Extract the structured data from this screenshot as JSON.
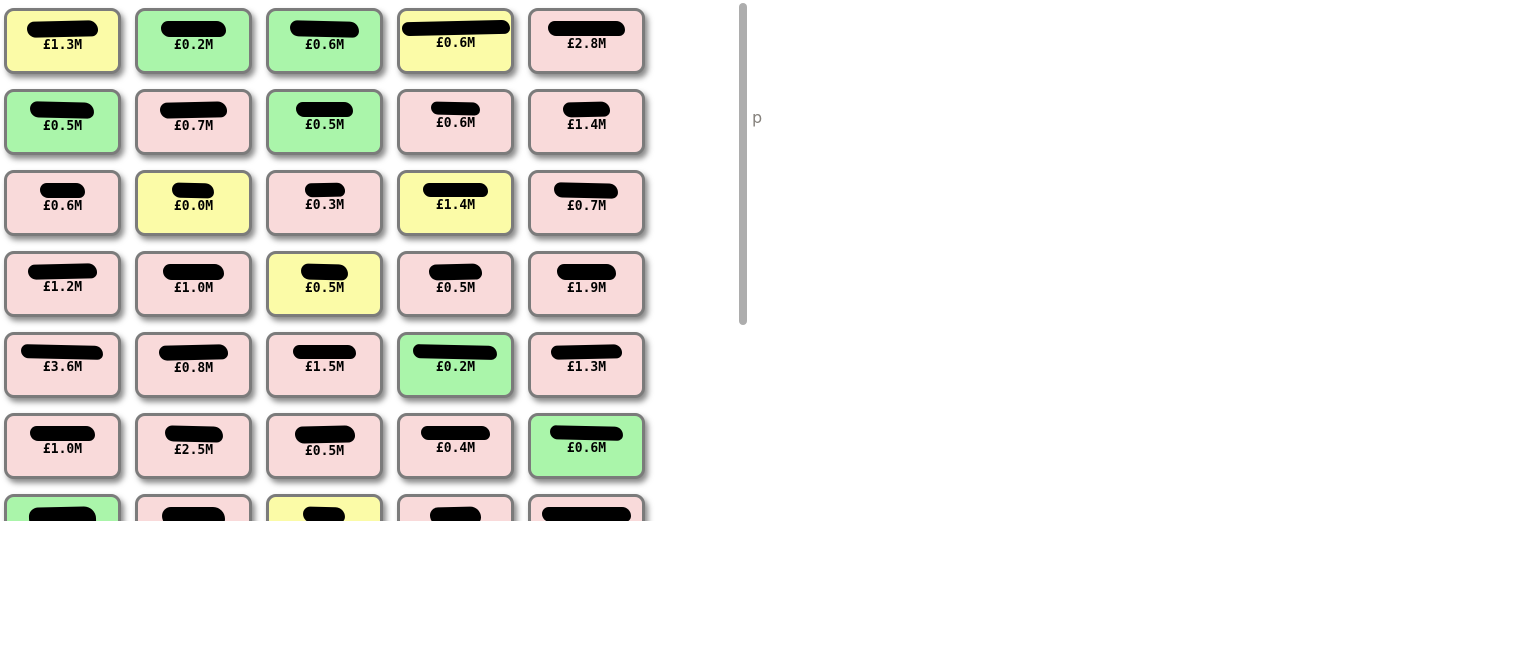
{
  "page": {
    "background": "#ffffff",
    "stray_text": "p"
  },
  "colors": {
    "yellow": "#fbfba7",
    "green": "#aaf5aa",
    "pink": "#f9dada",
    "tile_border": "#7b7b7b",
    "scrollbar": "#adadad",
    "stray_text_color": "#85817c",
    "redaction": "#000000",
    "value_text": "#000000"
  },
  "grid": {
    "columns": 5,
    "rows_visible": 7,
    "last_row_clipped": true
  },
  "tiles": [
    {
      "value": "£1.3M",
      "color": "yellow",
      "redacted_width_pct": 64,
      "redacted_height": 16
    },
    {
      "value": "£0.2M",
      "color": "green",
      "redacted_width_pct": 58,
      "redacted_height": 16
    },
    {
      "value": "£0.6M",
      "color": "green",
      "redacted_width_pct": 62,
      "redacted_height": 16
    },
    {
      "value": "£0.6M",
      "color": "yellow",
      "redacted_width_pct": 97,
      "redacted_height": 14
    },
    {
      "value": "£2.8M",
      "color": "pink",
      "redacted_width_pct": 70,
      "redacted_height": 15
    },
    {
      "value": "£0.5M",
      "color": "green",
      "redacted_width_pct": 58,
      "redacted_height": 16
    },
    {
      "value": "£0.7M",
      "color": "pink",
      "redacted_width_pct": 60,
      "redacted_height": 16
    },
    {
      "value": "£0.5M",
      "color": "green",
      "redacted_width_pct": 52,
      "redacted_height": 15
    },
    {
      "value": "£0.6M",
      "color": "pink",
      "redacted_width_pct": 44,
      "redacted_height": 13
    },
    {
      "value": "£1.4M",
      "color": "pink",
      "redacted_width_pct": 42,
      "redacted_height": 15
    },
    {
      "value": "£0.6M",
      "color": "pink",
      "redacted_width_pct": 40,
      "redacted_height": 15
    },
    {
      "value": "£0.0M",
      "color": "yellow",
      "redacted_width_pct": 38,
      "redacted_height": 15
    },
    {
      "value": "£0.3M",
      "color": "pink",
      "redacted_width_pct": 36,
      "redacted_height": 14
    },
    {
      "value": "£1.4M",
      "color": "yellow",
      "redacted_width_pct": 58,
      "redacted_height": 14
    },
    {
      "value": "£0.7M",
      "color": "pink",
      "redacted_width_pct": 58,
      "redacted_height": 15
    },
    {
      "value": "£1.2M",
      "color": "pink",
      "redacted_width_pct": 62,
      "redacted_height": 15
    },
    {
      "value": "£1.0M",
      "color": "pink",
      "redacted_width_pct": 55,
      "redacted_height": 16
    },
    {
      "value": "£0.5M",
      "color": "yellow",
      "redacted_width_pct": 42,
      "redacted_height": 16
    },
    {
      "value": "£0.5M",
      "color": "pink",
      "redacted_width_pct": 48,
      "redacted_height": 16
    },
    {
      "value": "£1.9M",
      "color": "pink",
      "redacted_width_pct": 54,
      "redacted_height": 16
    },
    {
      "value": "£3.6M",
      "color": "pink",
      "redacted_width_pct": 74,
      "redacted_height": 14
    },
    {
      "value": "£0.8M",
      "color": "pink",
      "redacted_width_pct": 62,
      "redacted_height": 15
    },
    {
      "value": "£1.5M",
      "color": "pink",
      "redacted_width_pct": 56,
      "redacted_height": 14
    },
    {
      "value": "£0.2M",
      "color": "green",
      "redacted_width_pct": 76,
      "redacted_height": 14
    },
    {
      "value": "£1.3M",
      "color": "pink",
      "redacted_width_pct": 64,
      "redacted_height": 14
    },
    {
      "value": "£1.0M",
      "color": "pink",
      "redacted_width_pct": 58,
      "redacted_height": 15
    },
    {
      "value": "£2.5M",
      "color": "pink",
      "redacted_width_pct": 52,
      "redacted_height": 16
    },
    {
      "value": "£0.5M",
      "color": "pink",
      "redacted_width_pct": 54,
      "redacted_height": 17
    },
    {
      "value": "£0.4M",
      "color": "pink",
      "redacted_width_pct": 62,
      "redacted_height": 14
    },
    {
      "value": "£0.6M",
      "color": "green",
      "redacted_width_pct": 66,
      "redacted_height": 14
    },
    {
      "value": "",
      "color": "green",
      "redacted_width_pct": 60,
      "redacted_height": 22
    },
    {
      "value": "",
      "color": "pink",
      "redacted_width_pct": 56,
      "redacted_height": 20
    },
    {
      "value": "",
      "color": "yellow",
      "redacted_width_pct": 38,
      "redacted_height": 16
    },
    {
      "value": "",
      "color": "pink",
      "redacted_width_pct": 46,
      "redacted_height": 18
    },
    {
      "value": "",
      "color": "pink",
      "redacted_width_pct": 80,
      "redacted_height": 15
    }
  ]
}
